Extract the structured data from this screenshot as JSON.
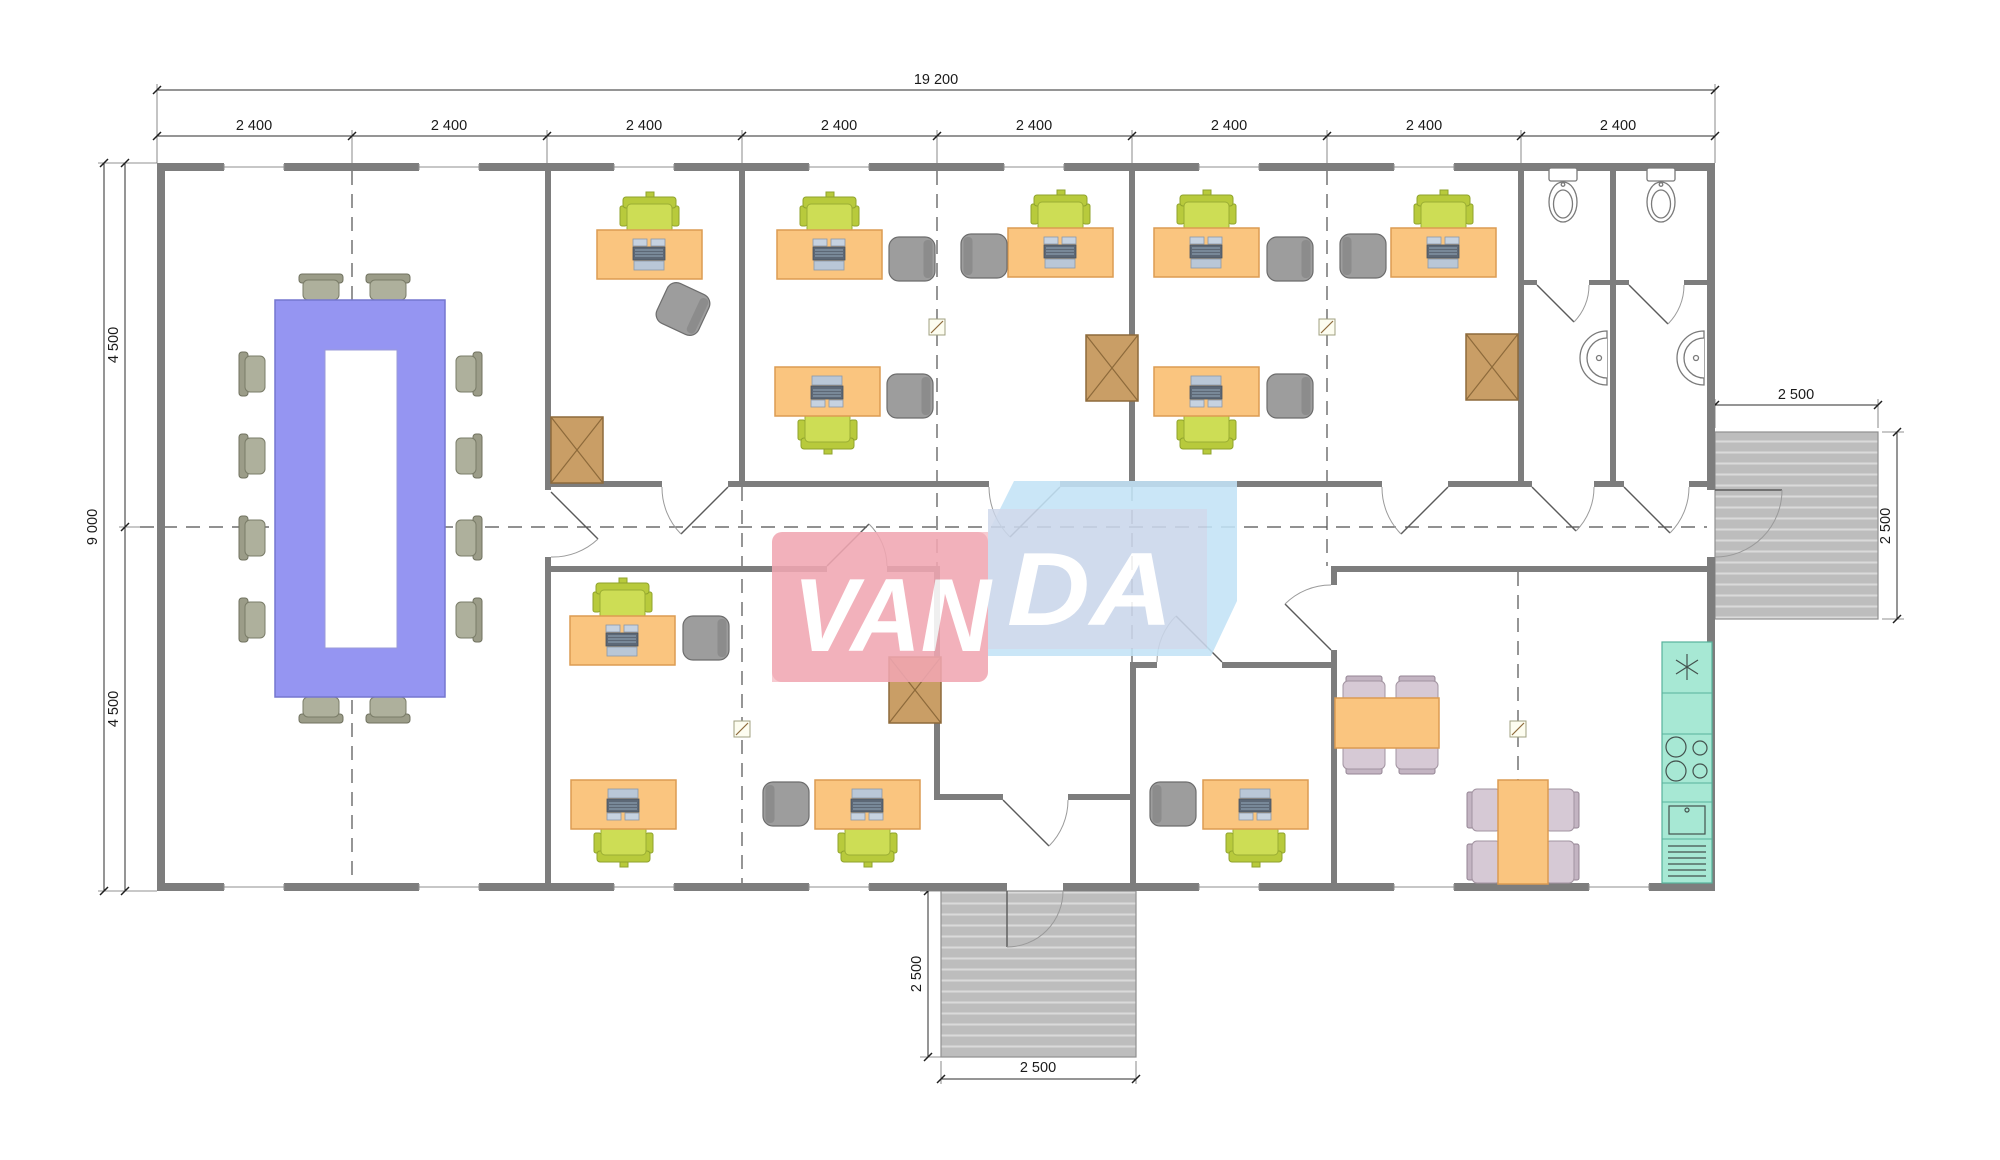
{
  "watermark": {
    "left_text": "VAN",
    "right_text": "DA"
  },
  "dimensions": {
    "overall_width": "19 200",
    "bay": "2 400",
    "overall_height": "9 000",
    "half_height": "4 500",
    "porch": "2 500"
  },
  "colors": {
    "wall": "#7d7d7d",
    "desk": "#FAC57F",
    "task_chair_green": "#CDDD55",
    "guest_chair_gray": "#9D9D9D",
    "conference_table_purple": "#9595F2",
    "conference_chair": "#AEB09C",
    "cabinet_tan": "#C99E66",
    "kitchen_counter_teal": "#A7E8D4",
    "dining_chair_mauve": "#D6C9D5",
    "porch_deck_gray": "#BDBDBD",
    "logo_pink": "#F1A7B2",
    "logo_blue": "#C3E3F7",
    "logo_panel_blue": "#CBD5E9"
  }
}
